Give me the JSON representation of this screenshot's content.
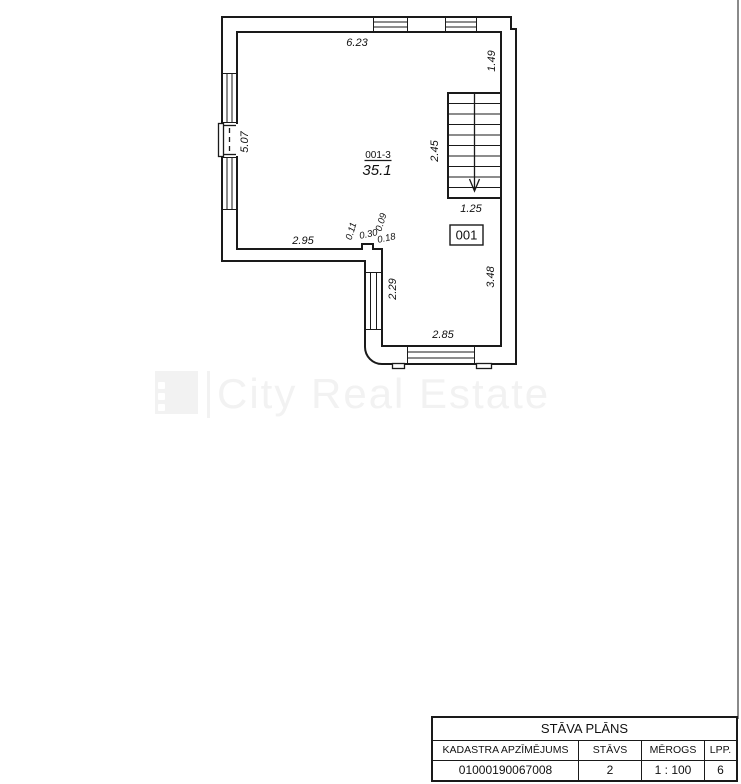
{
  "colors": {
    "line": "#1a1a1a",
    "watermark": "#f2f2f2",
    "page_edge": "#8a8a8a"
  },
  "floor_plan": {
    "room": {
      "code": "001-3",
      "area": "35.1",
      "number": "001"
    },
    "dimensions": {
      "top_wall": "6.23",
      "right_wall_upper": "1.49",
      "left_wall": "5.07",
      "left_section_bottom": "2.95",
      "step_offset_1": "0.11",
      "step_width": "0.30",
      "step_offset_2": "0.09",
      "step_offset_3": "0.18",
      "lower_left_wall": "2.29",
      "lower_right_wall": "3.48",
      "lower_bottom_wall": "2.85",
      "stairs_length": "2.45",
      "stairs_width": "1.25"
    }
  },
  "watermark": {
    "brand": "City Real Estate"
  },
  "title_block": {
    "title": "STĀVA PLĀNS",
    "columns": [
      {
        "header": "KADASTRA APZĪMĒJUMS",
        "value": "01000190067008"
      },
      {
        "header": "STĀVS",
        "value": "2"
      },
      {
        "header": "MĒROGS",
        "value": "1 : 100"
      },
      {
        "header": "LPP.",
        "value": "6"
      }
    ]
  }
}
